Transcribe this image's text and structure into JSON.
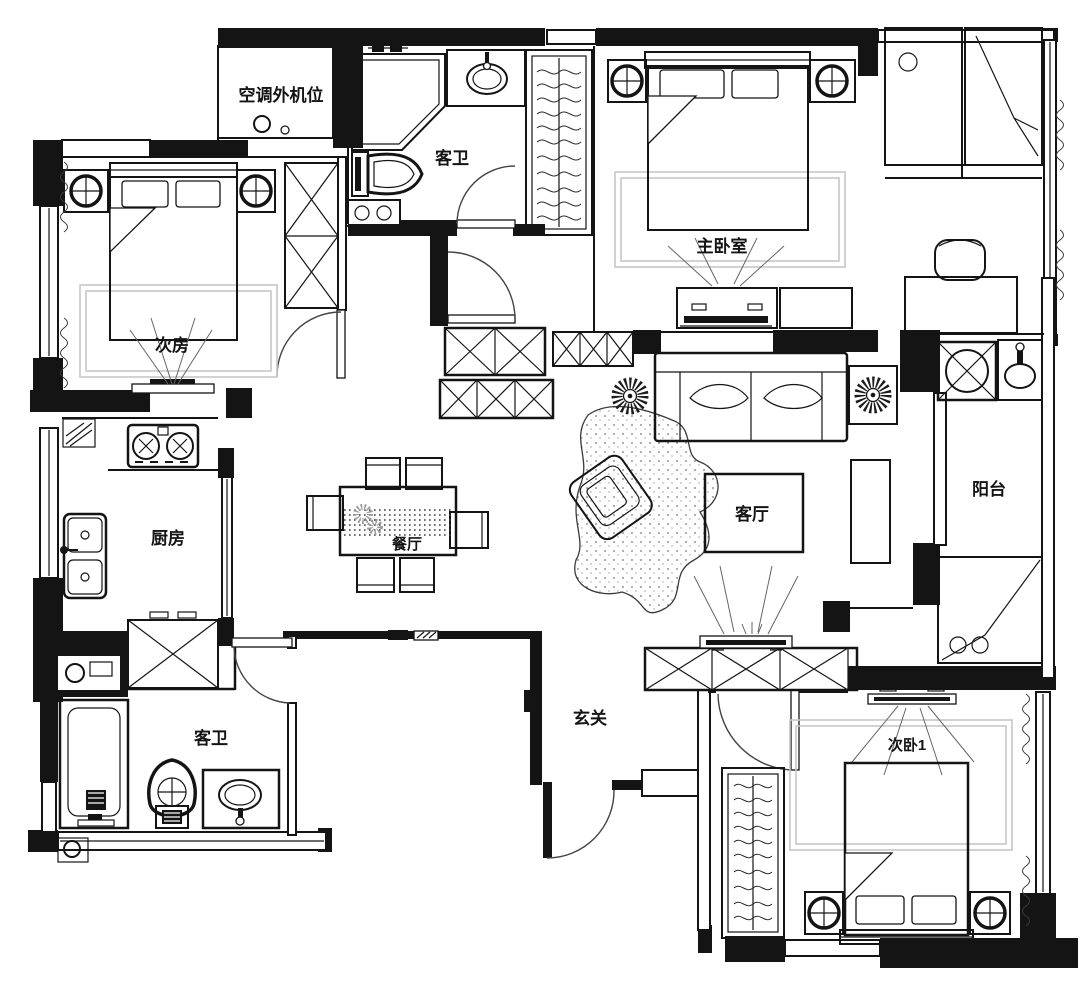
{
  "plan": {
    "type": "residential-floor-plan",
    "style": "black-and-white architectural line drawing",
    "colors": {
      "walls": "#141414",
      "lines": "#1d1d1d",
      "carpet": "#c7c7c7",
      "background": "#ffffff"
    },
    "rooms": [
      {
        "name": "ac-outdoor-unit-bay",
        "label": "空调外机位"
      },
      {
        "name": "guest-bathroom-top",
        "label": "客卫"
      },
      {
        "name": "master-bedroom",
        "label": "主卧室"
      },
      {
        "name": "secondary-room",
        "label": "次房"
      },
      {
        "name": "kitchen",
        "label": "厨房"
      },
      {
        "name": "dining-room",
        "label": "餐厅"
      },
      {
        "name": "living-room",
        "label": "客厅"
      },
      {
        "name": "balcony",
        "label": "阳台"
      },
      {
        "name": "guest-bathroom-bottom",
        "label": "客卫"
      },
      {
        "name": "entry-foyer",
        "label": "玄关"
      },
      {
        "name": "secondary-bedroom-1",
        "label": "次卧1"
      }
    ],
    "fixtures": {
      "double-beds": 3,
      "shower-enclosure": 1,
      "toilets": 2,
      "bathtub": 1,
      "wash-basins": 4,
      "gas-stove": 1,
      "kitchen-sink": 1,
      "washing-machine": 1,
      "dining-table-seats": 6,
      "sofa": 1,
      "armchair": 1,
      "coffee-table": 1,
      "tv-units": 4,
      "wardrobes": 4,
      "potted-plants": 2
    }
  }
}
